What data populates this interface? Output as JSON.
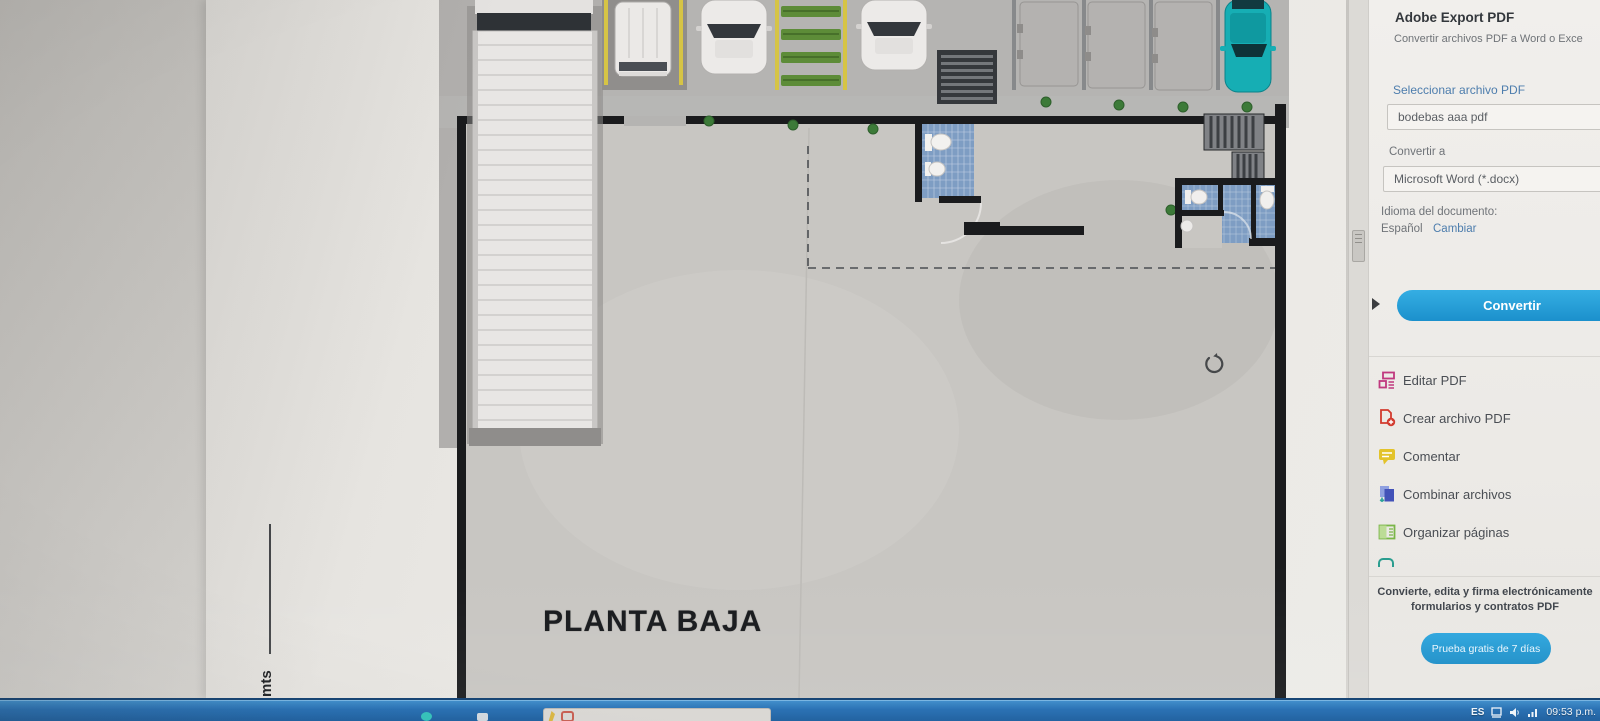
{
  "export_panel": {
    "title": "Adobe Export PDF",
    "subtitle": "Convertir archivos PDF a Word o Exce",
    "select_file_label": "Seleccionar archivo PDF",
    "file_name": "bodebas aaa pdf",
    "convert_to_label": "Convertir a",
    "format_value": "Microsoft Word (*.docx)",
    "language_label": "Idioma del documento:",
    "language_value": "Español",
    "language_change_link": "Cambiar",
    "convert_button": "Convertir"
  },
  "tools": [
    {
      "label": "Editar PDF",
      "icon": "edit-pdf-icon",
      "color": "#c0397f"
    },
    {
      "label": "Crear archivo PDF",
      "icon": "create-pdf-icon",
      "color": "#d23a2e"
    },
    {
      "label": "Comentar",
      "icon": "comment-icon",
      "color": "#e3c32a"
    },
    {
      "label": "Combinar archivos",
      "icon": "combine-files-icon",
      "color": "#4252b8"
    },
    {
      "label": "Organizar páginas",
      "icon": "organize-pages-icon",
      "color": "#7ab648"
    }
  ],
  "promo": {
    "line1": "Convierte, edita y firma electrónicamente",
    "line2": "formularios y contratos PDF",
    "trial_button": "Prueba gratis de 7 días"
  },
  "document": {
    "plan_title": "PLANTA BAJA",
    "scale_label": "mts"
  },
  "taskbar": {
    "language": "ES",
    "clock": "09:53 p.m."
  },
  "colors": {
    "accent_blue": "#1b90cc",
    "link_blue": "#4d7dad",
    "taskbar_blue": "#1f6ab0",
    "teal_car": "#16aeb4",
    "bathroom_tile": "#7e9dc3",
    "wall_black": "#1a1b1d"
  }
}
